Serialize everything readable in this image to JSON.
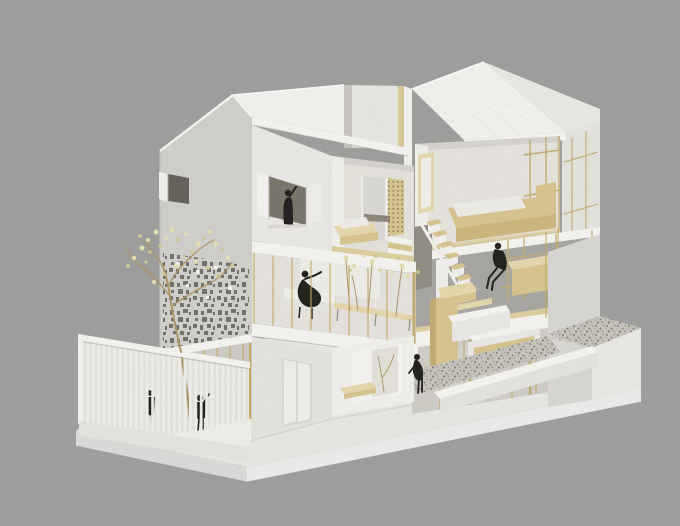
{
  "meta": {
    "description": "Photograph of a white architectural scale model: a three-storey gabled house with cut-away facades revealing plywood interiors, black paper figure silhouettes, a blossoming wire tree, a slatted terrace fence and gravel courts, set on a white base against a grey background."
  },
  "palette": {
    "bg": "#9c9c9b",
    "ground": "#e9e9e6",
    "baseLeft": "#dcddda",
    "baseRight": "#eff0ee",
    "edge": "#8f8f8d",
    "wallBright": "#f5f4f1",
    "wallWhite": "#edebe7",
    "wallGray": "#d1d0cc",
    "wallShade": "#e7e5e0",
    "wallDark": "#d9d8d4",
    "fascia": "#f8f7f4",
    "shadowLine": "#aeaca7",
    "contact": "#cfcec9",
    "interior": "#e8e5df",
    "interiorBright": "#f3f2ee",
    "interiorShadow": "#d8d5cf",
    "backWall": "#e6e3dc",
    "notchWall": "#eae8e3",
    "notchShadow": "#c9c6c0",
    "openingDark": "#756f64",
    "windowDark": "#5f5b54",
    "doorRecess": "#dcdad5",
    "doorLeaf": "#f2f1ed",
    "wood": "#d9c48c",
    "woodLight": "#e7d8ab",
    "woodDark": "#c3ab6e",
    "woodFloor": "#dfcf9e",
    "woodShadow": "#cdb678",
    "brass": "#c7a75f",
    "glass": "#cfccc5",
    "glassInterior": "#d9d6cf",
    "glassOverlay": "#c9c7c0",
    "mattress": "#f1efe9",
    "sofa": "#f2f1ec",
    "sofaFront": "#e8e6e0",
    "gravel": "#c6c4bb",
    "gravelDot1": "#8b897f",
    "gravelDot2": "#6f6d65",
    "gravelDot3": "#a3a198",
    "figure": "#181613",
    "blossom": "#e7e0af",
    "blossomDark": "#d2c88f",
    "branch": "#ab9260",
    "slat": "#f2f1ee",
    "fenceBack": "#e6e5e0",
    "floorThrough": "#f1f0eb",
    "fenceBase": "#e7e6e1",
    "lattice": "#d9c48e",
    "latticeDot": "#8d7d55",
    "stair": "#f4f3f0",
    "darkOpening": "#8e897f",
    "bgSeen": "#a5a4a0",
    "perfHole": "#6e6c66",
    "perfLit": "#f6f5f1",
    "shelfDark": "#8a8377",
    "legGray": "#8b8984"
  },
  "scene": {
    "building": {
      "volumes": [
        "left gabled volume with shuttered window and perforated screen wall",
        "right gabled volume with open cut-away floors"
      ],
      "floors": 3
    },
    "figures": [
      {
        "id": "waving-figure",
        "label": "person waving from the upper shuttered window"
      },
      {
        "id": "seated-figure",
        "label": "person seated at the middle-floor table, arm raised"
      },
      {
        "id": "lounge-figure",
        "label": "person reclining in a chair on the middle floor"
      },
      {
        "id": "gardener-figure",
        "label": "person bending over the gravel garden"
      },
      {
        "id": "child-figure-1",
        "label": "child behind the slatted terrace fence"
      },
      {
        "id": "child-figure-2",
        "label": "child behind the slatted terrace fence"
      }
    ],
    "elements": [
      "gabled white roofs with cut notch",
      "perforated screen wall",
      "blossoming tree",
      "vertical slatted fence around terrace",
      "zig-zag staircase with wooden treads",
      "brass framed glazing",
      "wooden bed, table, planters",
      "gravel courts on white base"
    ]
  }
}
